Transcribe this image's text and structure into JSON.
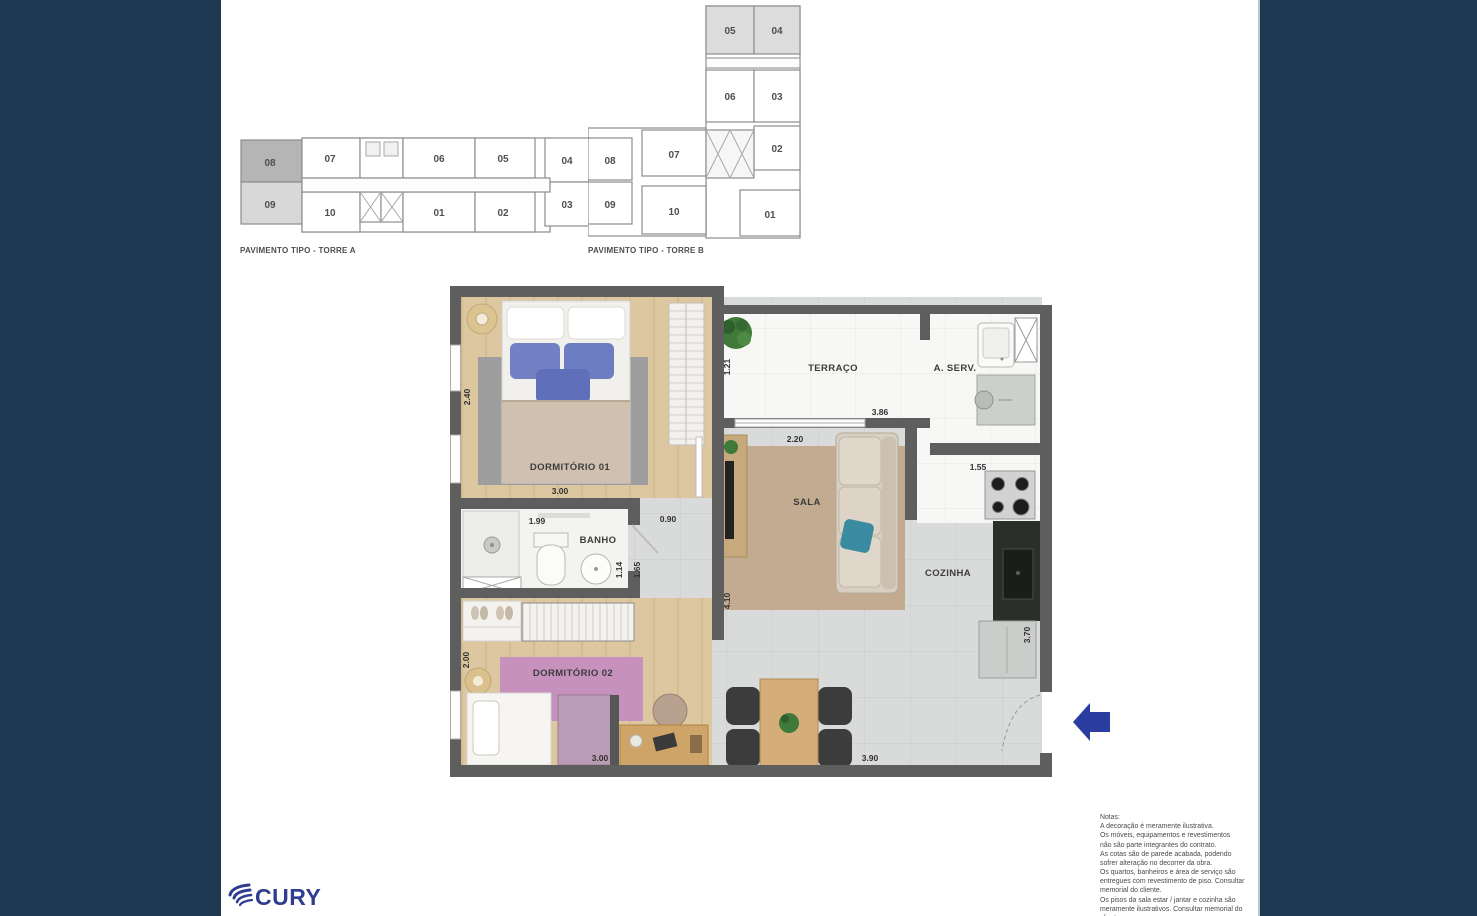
{
  "key_plans": {
    "torre_a": {
      "caption": "PAVIMENTO TIPO - TORRE A",
      "units": [
        "08",
        "09",
        "07",
        "10",
        "06",
        "01",
        "05",
        "02",
        "04",
        "03"
      ]
    },
    "torre_b": {
      "caption": "PAVIMENTO TIPO - TORRE B",
      "units": [
        "05",
        "04",
        "06",
        "03",
        "02",
        "01",
        "08",
        "07",
        "09",
        "10"
      ]
    }
  },
  "floor_plan": {
    "rooms": {
      "dorm1": "DORMITÓRIO 01",
      "terraco": "TERRAÇO",
      "aserv": "A. SERV.",
      "sala": "SALA",
      "banho": "BANHO",
      "cozinha": "COZINHA",
      "dorm2": "DORMITÓRIO 02"
    },
    "dims": {
      "dorm1_h": "2.40",
      "dorm1_w": "3.00",
      "banho_w": "1.99",
      "hall_w": "0.90",
      "terraco_h": "1.21",
      "terraco_w": "3.86",
      "sala_w": "2.20",
      "cozinha_w": "1.55",
      "banho_h": "1.14",
      "hall_h": "1.65",
      "living_h": "4.10",
      "cozinha_h": "3.70",
      "dorm2_h": "2.00",
      "dorm2_w": "3.00",
      "living_w": "3.90"
    }
  },
  "notes": {
    "title": "Notas:",
    "lines": [
      "A decoração é meramente ilustrativa.",
      "Os móveis, equipamentos e revestimentos",
      "não são parte integrantes do contrato.",
      "As cotas são de parede acabada, podendo",
      "sofrer alteração no decorrer da obra.",
      "Os quartos, banheiros e área de serviço são",
      "entregues com revestimento de piso. Consultar",
      "memorial do cliente.",
      "Os pisos da sala estar / jantar e cozinha são",
      "meramente ilustrativos. Consultar memorial do",
      "cliente."
    ]
  },
  "logo": {
    "text": "CURY"
  },
  "colors": {
    "panel_navy": "#1e3a52",
    "arrow_blue": "#2b3da1",
    "logo_blue": "#2e3d8f",
    "wall_gray": "#5e5e5e"
  }
}
